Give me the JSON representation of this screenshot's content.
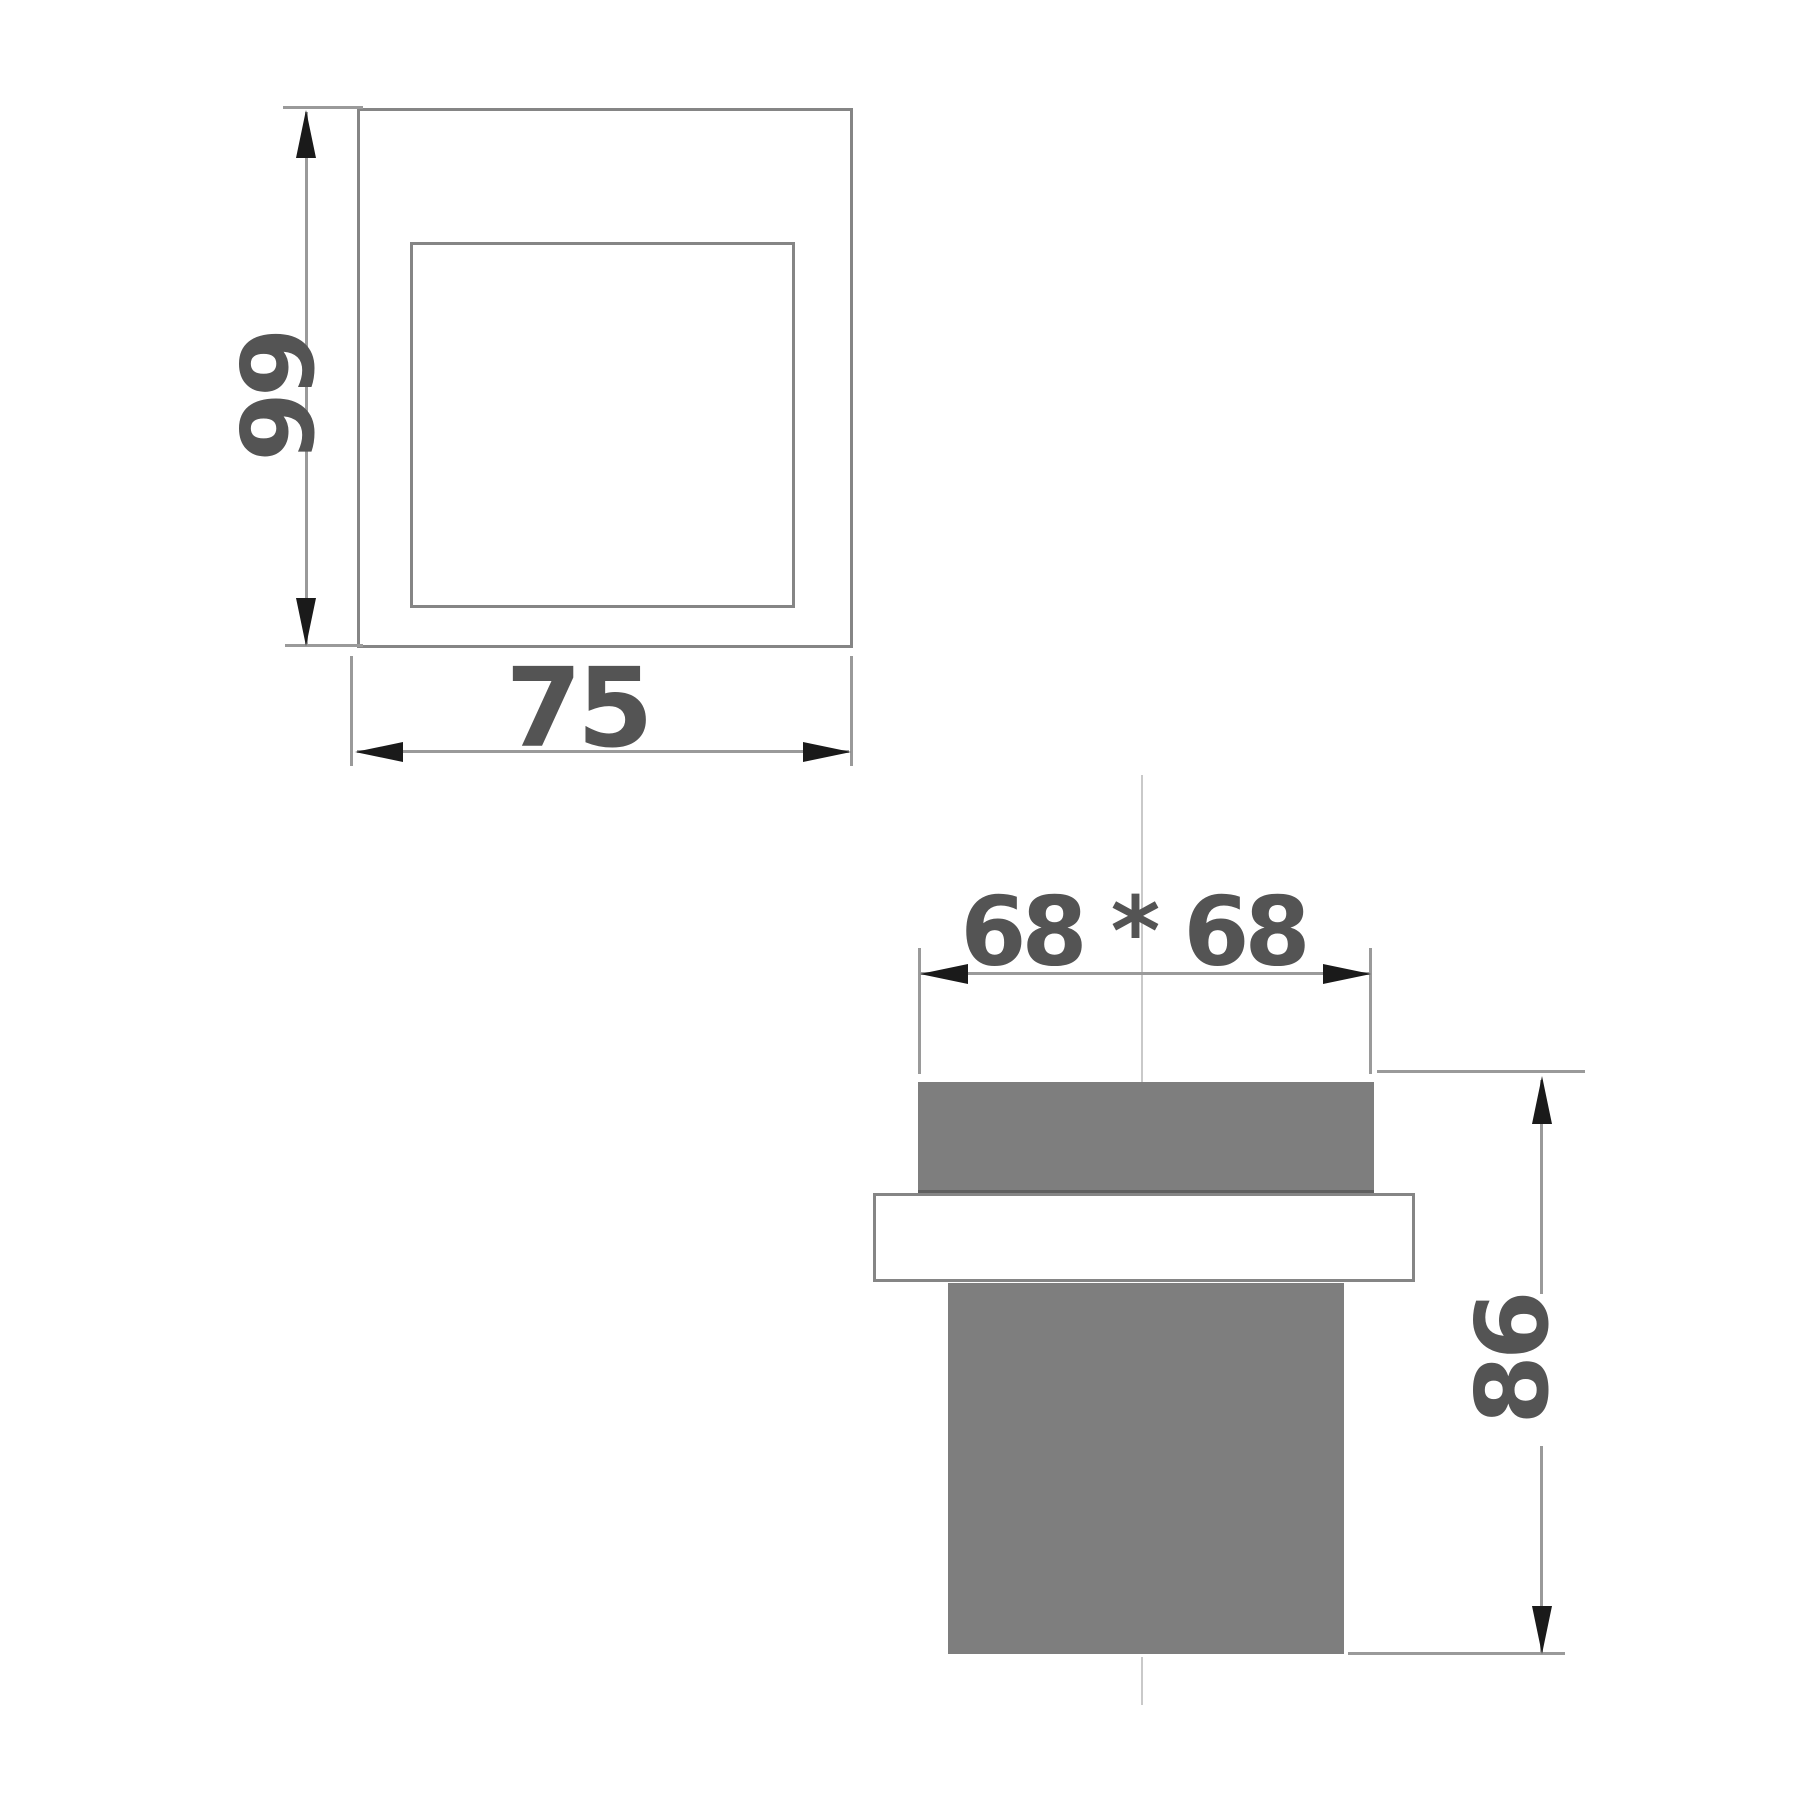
{
  "drawing": {
    "plan_view": {
      "height_dim": "99",
      "width_dim": "75"
    },
    "side_view": {
      "width_dim": "68 * 68",
      "height_dim": "86"
    }
  },
  "colors": {
    "block_fill_gray": "#7e7e7e",
    "drafting_line_gray": "#9a9a9a",
    "outline_gray": "#858585",
    "arrowhead_black": "#1a1a1a",
    "dimension_text_gray": "#545454",
    "centerline_gray": "#c9c9c9",
    "background": "#ffffff"
  }
}
